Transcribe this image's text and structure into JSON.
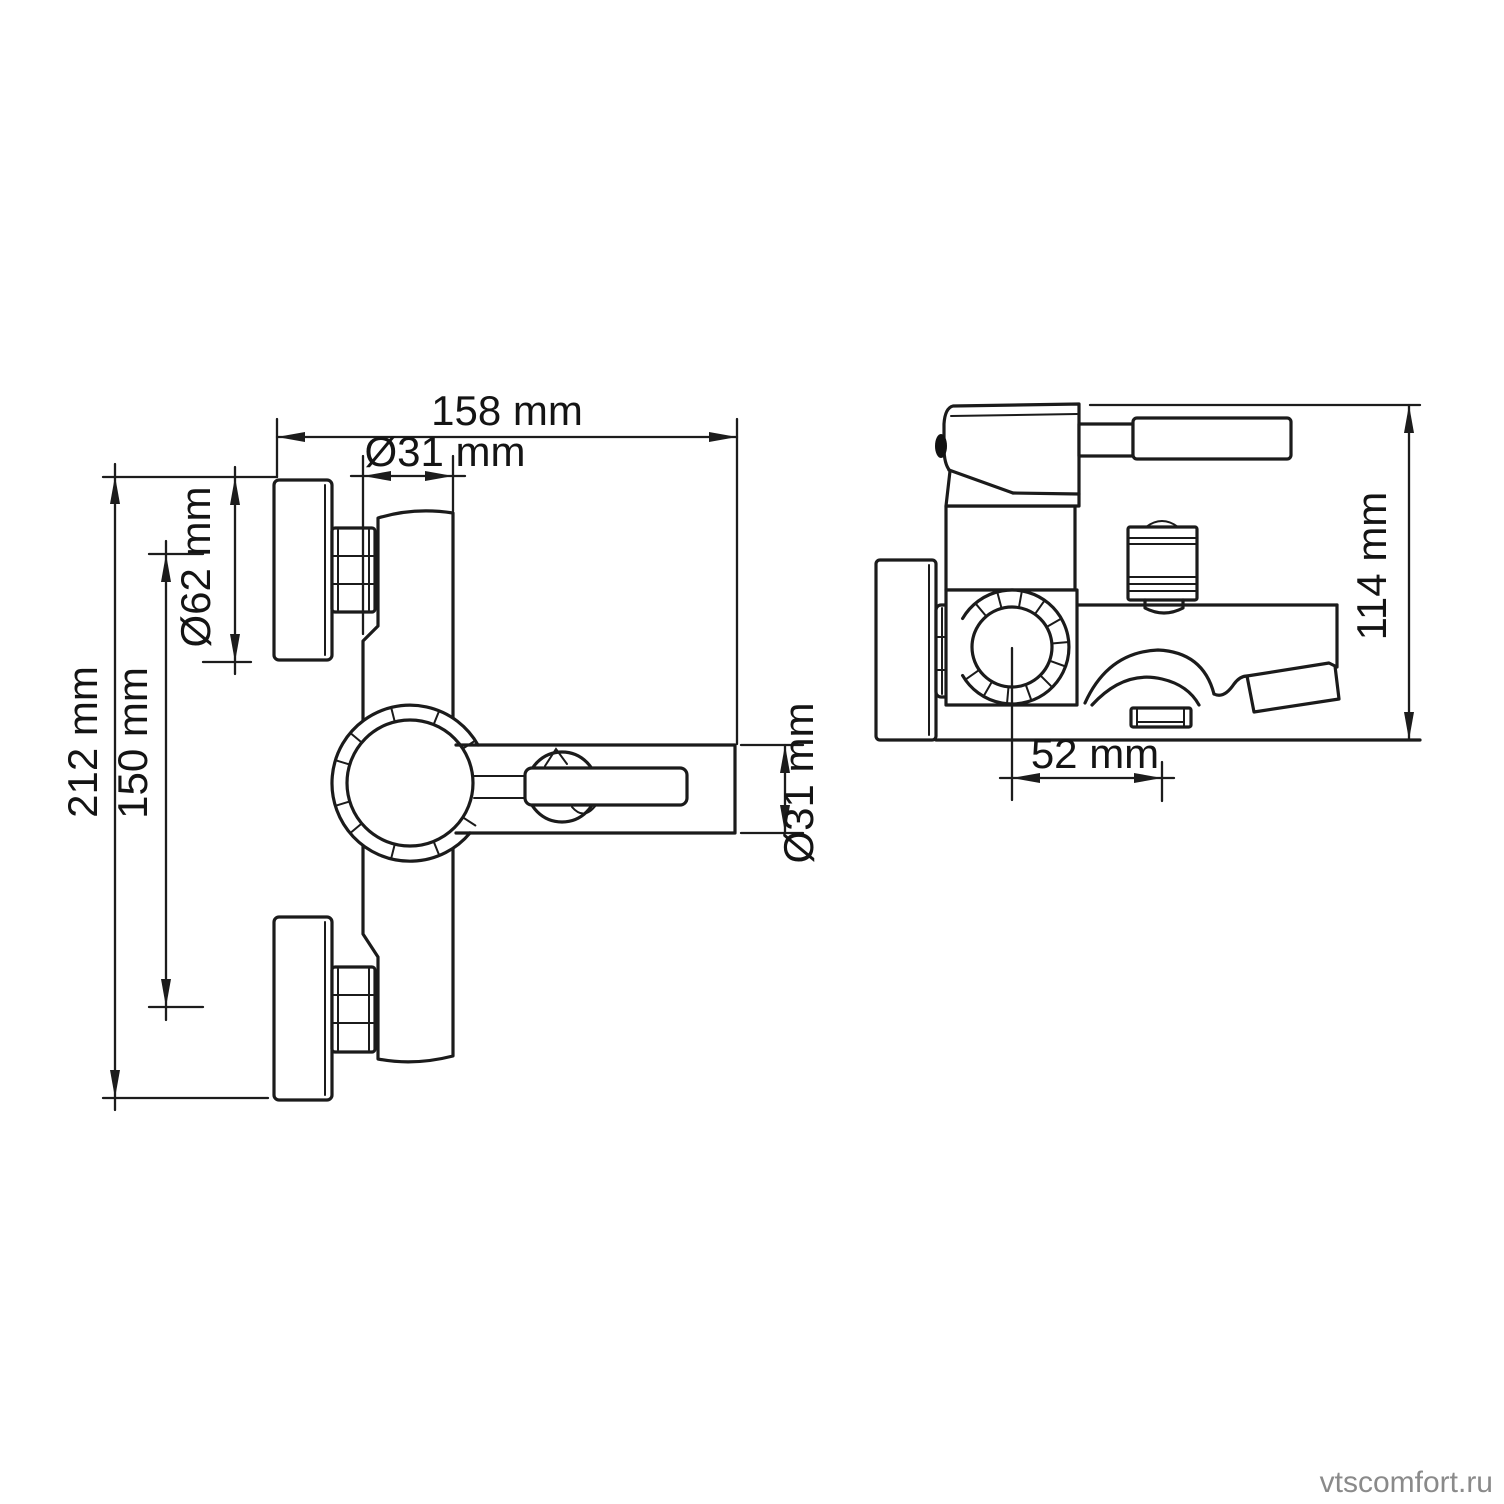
{
  "page": {
    "background": "#ffffff",
    "line_color": "#1b1b1b",
    "text_color": "#141414"
  },
  "watermark": {
    "text": "vtscomfort.ru",
    "color": "#8a8a8a"
  },
  "drawing": {
    "type": "technical-drawing",
    "subject": "wall-mounted bath mixer faucet, two orthographic views",
    "front_view": {
      "name": "front view",
      "dimensions": {
        "overall_width": "158 mm",
        "body_diameter_top": "Ø31 mm",
        "escutcheon_diameter": "Ø62 mm",
        "connection_spacing": "150 mm",
        "overall_height": "212 mm",
        "arm_diameter": "Ø31 mm"
      }
    },
    "side_view": {
      "name": "side view",
      "dimensions": {
        "overall_depth": "114 mm",
        "wall_to_spout_center": "52 mm"
      }
    }
  }
}
